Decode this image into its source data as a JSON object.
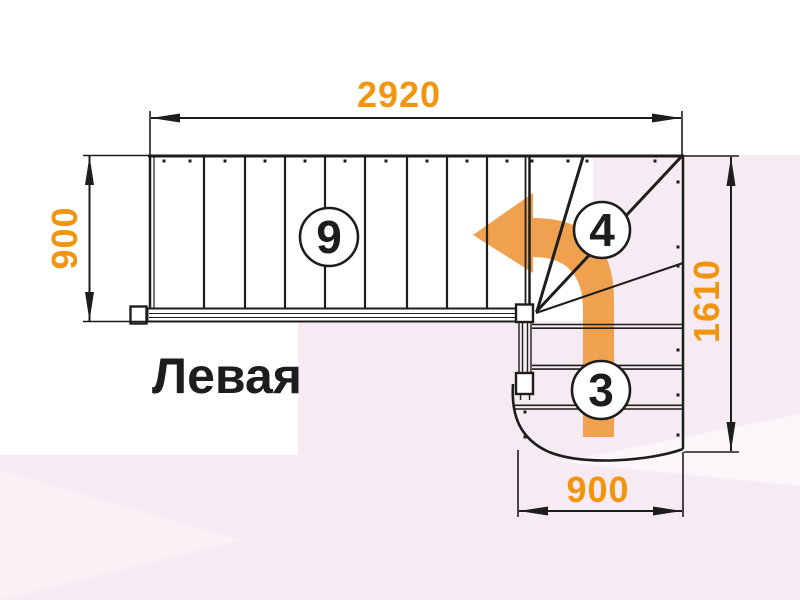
{
  "title": "Левая",
  "dimensions": {
    "top": "2920",
    "left": "900",
    "right": "1610",
    "bottom": "900"
  },
  "step_labels": {
    "straight_flight": "9",
    "winder": "4",
    "bottom_flight": "3"
  },
  "colors": {
    "dimension_text": "#f2950e",
    "arrow": "#efa150",
    "line": "#1d1d1b",
    "background_pink": "#f6ebf2",
    "background_white": "#ffffff"
  }
}
